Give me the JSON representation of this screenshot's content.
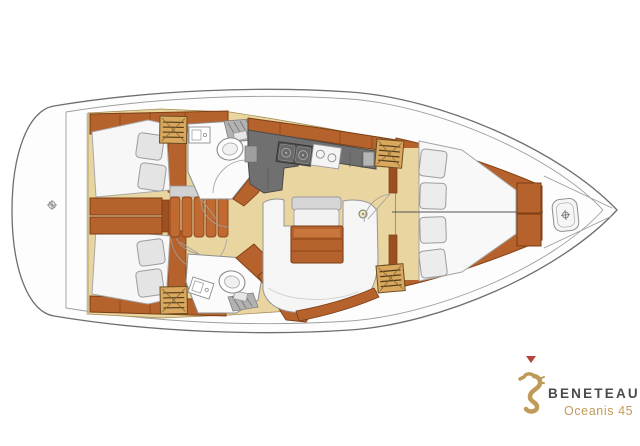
{
  "brand": {
    "name": "BENETEAU",
    "model": "Oceanis 45",
    "marker_color": "#b5443c",
    "name_color": "#4a4a4a",
    "model_color": "#c49a5a",
    "seahorse_icon_color": "#c09a58"
  },
  "palette": {
    "background": "#ffffff",
    "hull_outline": "#6e6e6e",
    "deck": "#fdfdfd",
    "floor_teak": "#e9d5a0",
    "wood_furniture": "#b5622d",
    "wood_edge": "#7c3e14",
    "galley_counter": "#707070",
    "upholstery_white": "#f5f5f5",
    "cushion_grey": "#e4e4e4",
    "locker_louvre": "#d9a85e",
    "shower_grate": "#b2b2b2"
  }
}
